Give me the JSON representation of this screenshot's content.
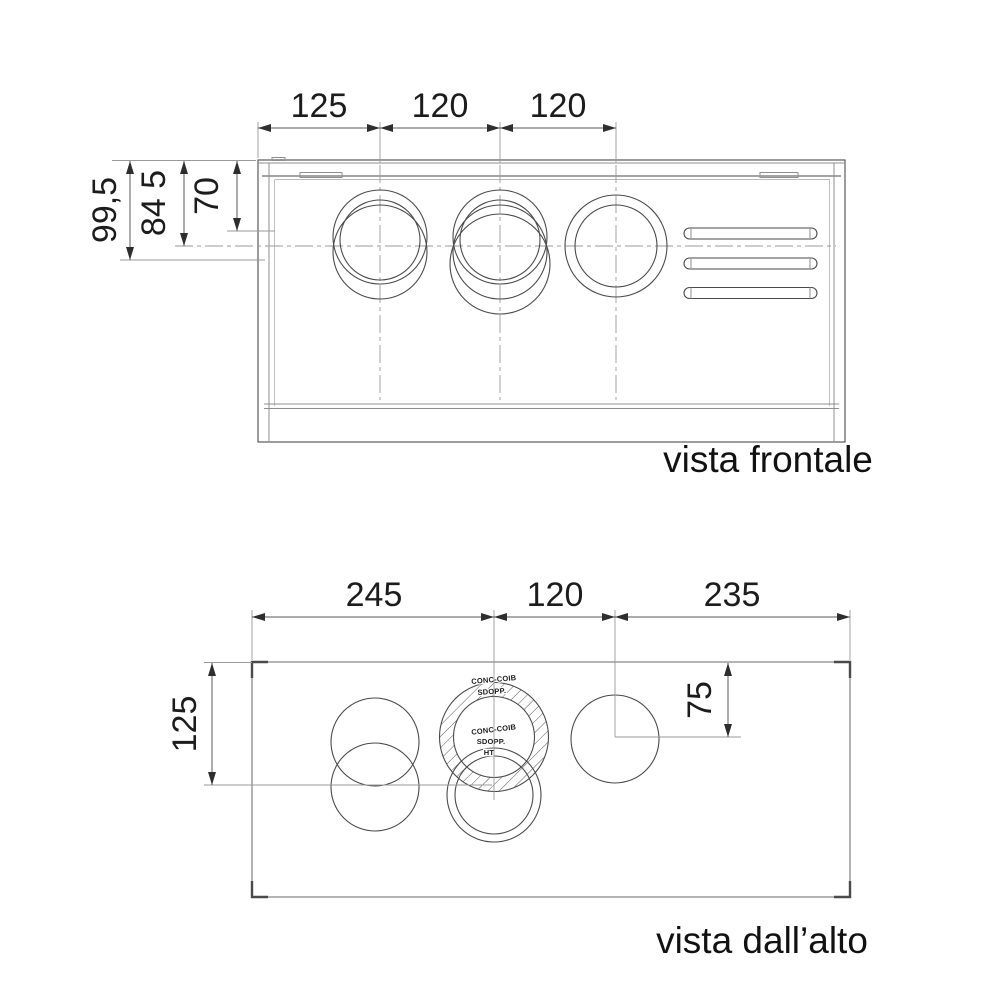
{
  "front_view": {
    "caption": "vista frontale",
    "dims_top": [
      "125",
      "120",
      "120"
    ],
    "dims_left": [
      "99,5",
      "84 5",
      "70"
    ]
  },
  "top_view": {
    "caption": "vista dall’alto",
    "dims_top": [
      "245",
      "120",
      "235"
    ],
    "dim_left": "125",
    "dim_right": "75",
    "flue_labels": {
      "upper_conc_coib": "CONC-COIB",
      "upper_sdopp": "SDOPP.",
      "inner_conc_coib": "CONC-COIB",
      "inner_sdopp": "SDOPP.",
      "inner_ht": "HT"
    }
  },
  "colors": {
    "line": "#4a4a4a",
    "frame_gray": "#949494",
    "text": "#1c1c1c",
    "arrow": "#2e2e2e",
    "background": "#ffffff"
  }
}
